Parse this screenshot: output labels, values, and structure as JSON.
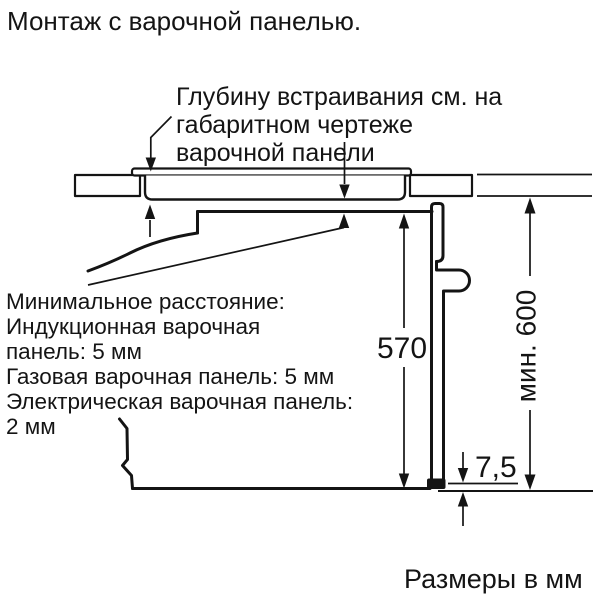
{
  "title": "Монтаж с варочной панелью.",
  "top_note": {
    "lines": [
      "Глубину встраивания см. на",
      "габаритном чертеже",
      "варочной панели"
    ]
  },
  "left_note": {
    "lines": [
      "Минимальное расстояние:",
      "Индукционная варочная",
      "панель: 5 мм",
      "Газовая варочная панель: 5 мм",
      "Электрическая варочная панель:",
      "2 мм"
    ]
  },
  "dimensions": {
    "oven_height": "570",
    "min_niche_height": "мин. 600",
    "rear_bottom_gap": "7,5"
  },
  "footer": "Размеры в мм",
  "colors": {
    "line": "#141414",
    "background": "#ffffff"
  }
}
